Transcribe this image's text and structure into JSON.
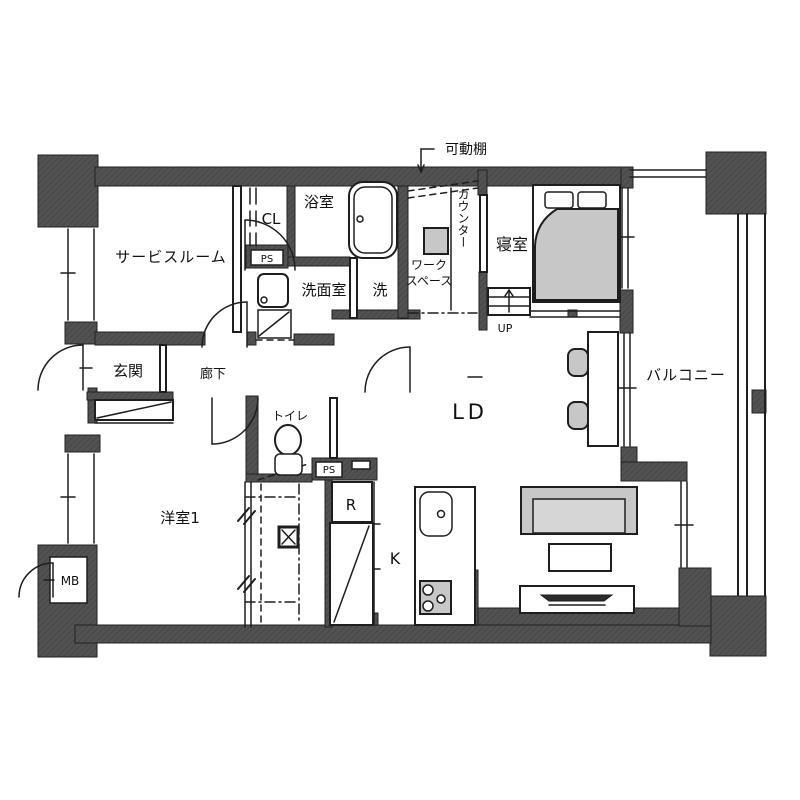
{
  "title": "マンション間取り図",
  "colors": {
    "wall": "#525252",
    "wall-line": "#3f3f3f",
    "furniture": "#c7c7c7",
    "furniture-light": "#d6d6d6",
    "line": "#1e1e1e",
    "bg": "#ffffff"
  },
  "rooms": {
    "service_room": "サービスルーム",
    "closet": "CL",
    "pipe_space_1": "PS",
    "bathroom": "浴室",
    "washroom": "洗面室",
    "laundry": "洗",
    "movable_shelf": "可動棚",
    "workspace_line1": "ワーク",
    "workspace_line2": "スペース",
    "counter": "カウンター",
    "bedroom": "寝室",
    "up": "UP",
    "balcony": "バルコニー",
    "entrance": "玄関",
    "corridor": "廊下",
    "toilet": "トイレ",
    "pipe_space_2": "PS",
    "refrigerator": "R",
    "western_room": "洋室1",
    "meter_box": "MB",
    "living_dining": "LD",
    "kitchen": "K"
  }
}
